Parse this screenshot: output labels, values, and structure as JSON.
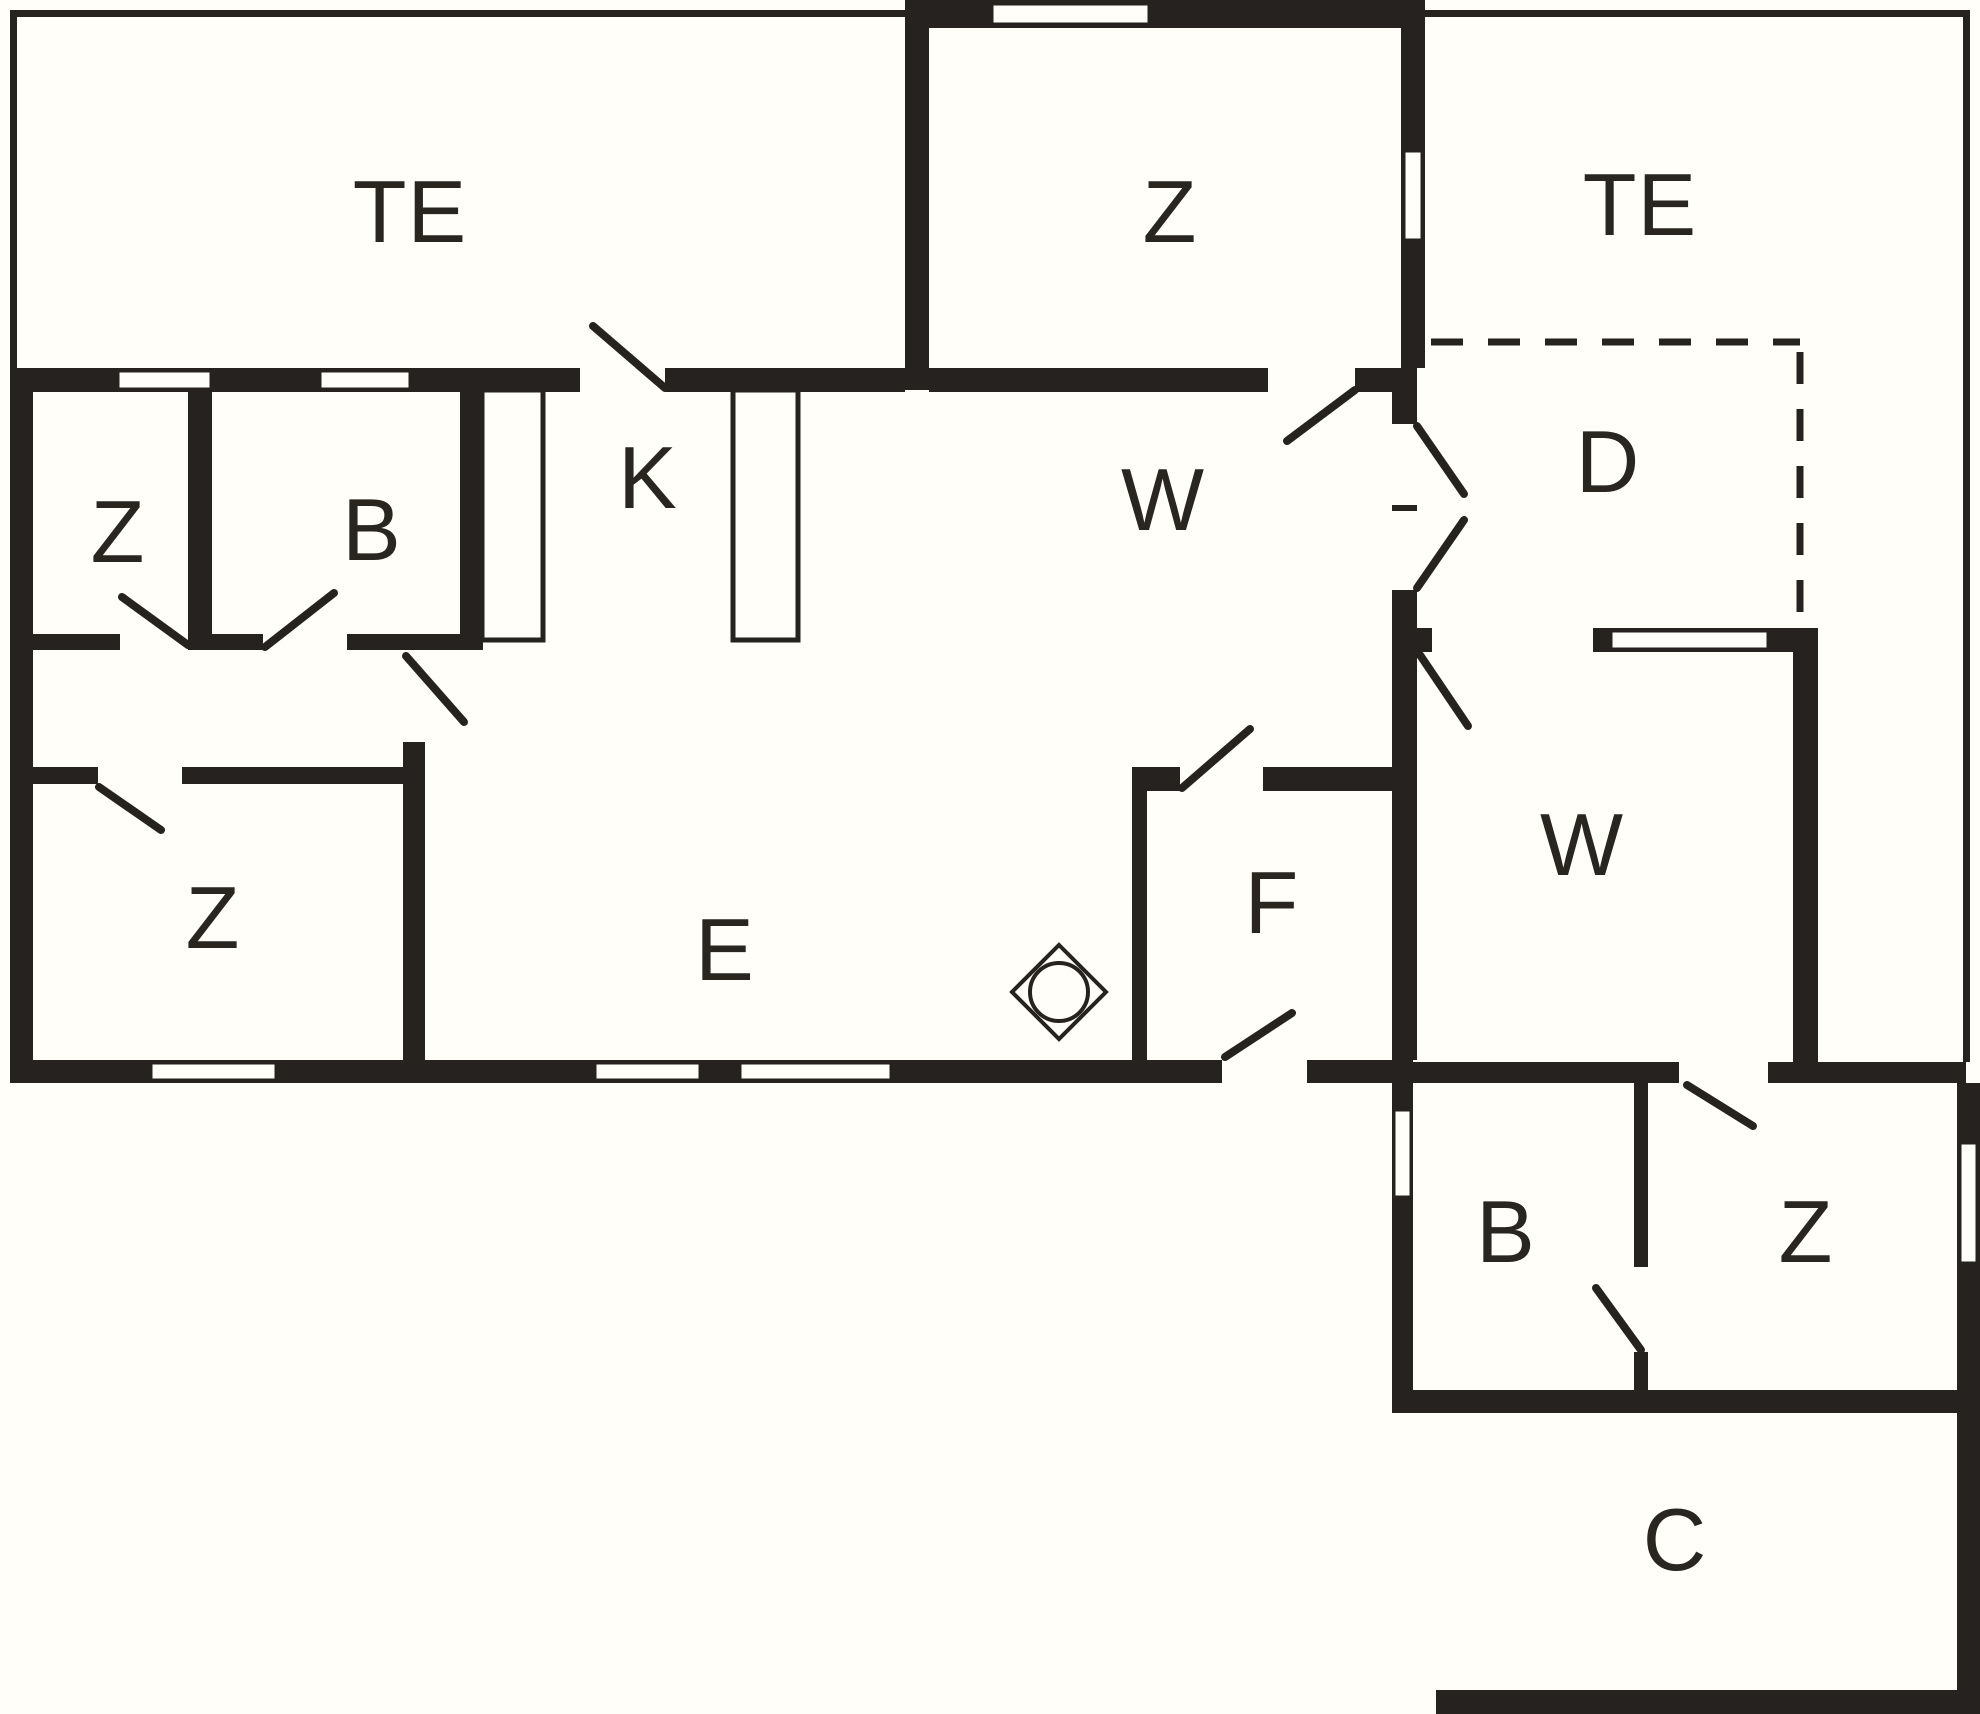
{
  "colors": {
    "background": "#fffef8",
    "wall": "#262220",
    "label": "#29251f"
  },
  "rooms": [
    {
      "id": "terrace-top-left",
      "label": "TE"
    },
    {
      "id": "bedroom-top",
      "label": "Z"
    },
    {
      "id": "terrace-top-right",
      "label": "TE"
    },
    {
      "id": "bedroom-upper-left",
      "label": "Z"
    },
    {
      "id": "bathroom-main",
      "label": "B"
    },
    {
      "id": "kitchen",
      "label": "K"
    },
    {
      "id": "living-room",
      "label": "W"
    },
    {
      "id": "entry",
      "label": "D"
    },
    {
      "id": "bedroom-lower-left",
      "label": "Z"
    },
    {
      "id": "dining-room",
      "label": "E"
    },
    {
      "id": "utility-room",
      "label": "F"
    },
    {
      "id": "living-room-right",
      "label": "W"
    },
    {
      "id": "bathroom-annex",
      "label": "B"
    },
    {
      "id": "bedroom-annex",
      "label": "Z"
    },
    {
      "id": "carport",
      "label": "C"
    }
  ],
  "symbols": [
    {
      "id": "fireplace",
      "name": "fireplace-symbol"
    }
  ]
}
